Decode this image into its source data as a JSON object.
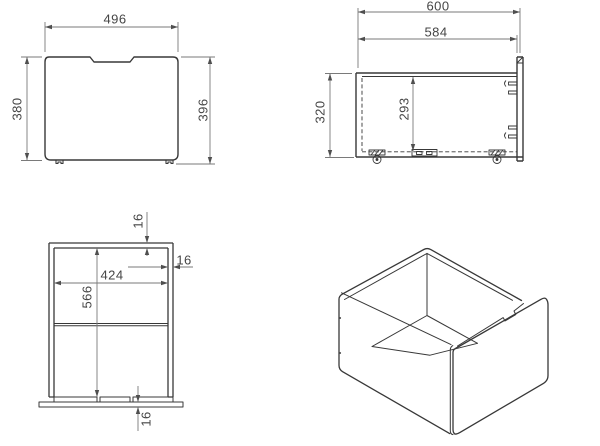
{
  "dimensions": {
    "front_view": {
      "width": "496",
      "height": "380",
      "height_total": "396"
    },
    "side_view": {
      "depth_total": "600",
      "depth_body": "584",
      "height": "320",
      "height_inner": "293"
    },
    "plan_view": {
      "width_inner": "424",
      "depth_inner": "566",
      "thickness_top": "16",
      "thickness_side": "16",
      "thickness_bottom": "16"
    }
  },
  "colors": {
    "geometry_line": "#383838",
    "dimension_line": "#7a7a7a",
    "arrow": "#4f4f4f",
    "text": "#454545",
    "background": "#ffffff"
  }
}
